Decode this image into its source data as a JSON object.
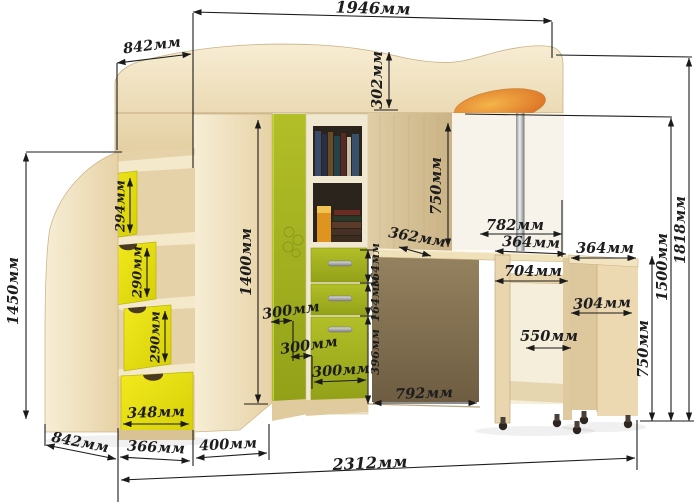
{
  "diagram": {
    "unit": "мм",
    "dims": {
      "d1946": "1946мм",
      "d842_top": "842мм",
      "d302": "302мм",
      "d1450": "1450мм",
      "d294": "294мм",
      "d290a": "290мм",
      "d290b": "290мм",
      "d348": "348мм",
      "d1400": "1400мм",
      "d300a": "300мм",
      "d300b": "300мм",
      "d300c": "300мм",
      "d164a": "164мм",
      "d164b": "164мм",
      "d396": "396мм",
      "d750_left": "750мм",
      "d362": "362мм",
      "d782": "782мм",
      "d364_desk": "364мм",
      "d704": "704мм",
      "d550": "550мм",
      "d792": "792мм",
      "d364_shelf": "364мм",
      "d304": "304мм",
      "d750_right": "750мм",
      "d1500": "1500мм",
      "d1818": "1818мм",
      "d842_bottom": "842мм",
      "d366": "366мм",
      "d400": "400мм",
      "d2312": "2312мм"
    },
    "colors": {
      "wood_light": "#f4e8cb",
      "wood_mid": "#e6d2a7",
      "wood_dark": "#8d7b5e",
      "accent_yellow": "#e9e011",
      "accent_green": "#a7b421",
      "accent_orange": "#e07b2a",
      "line": "#1b1b1b"
    }
  }
}
